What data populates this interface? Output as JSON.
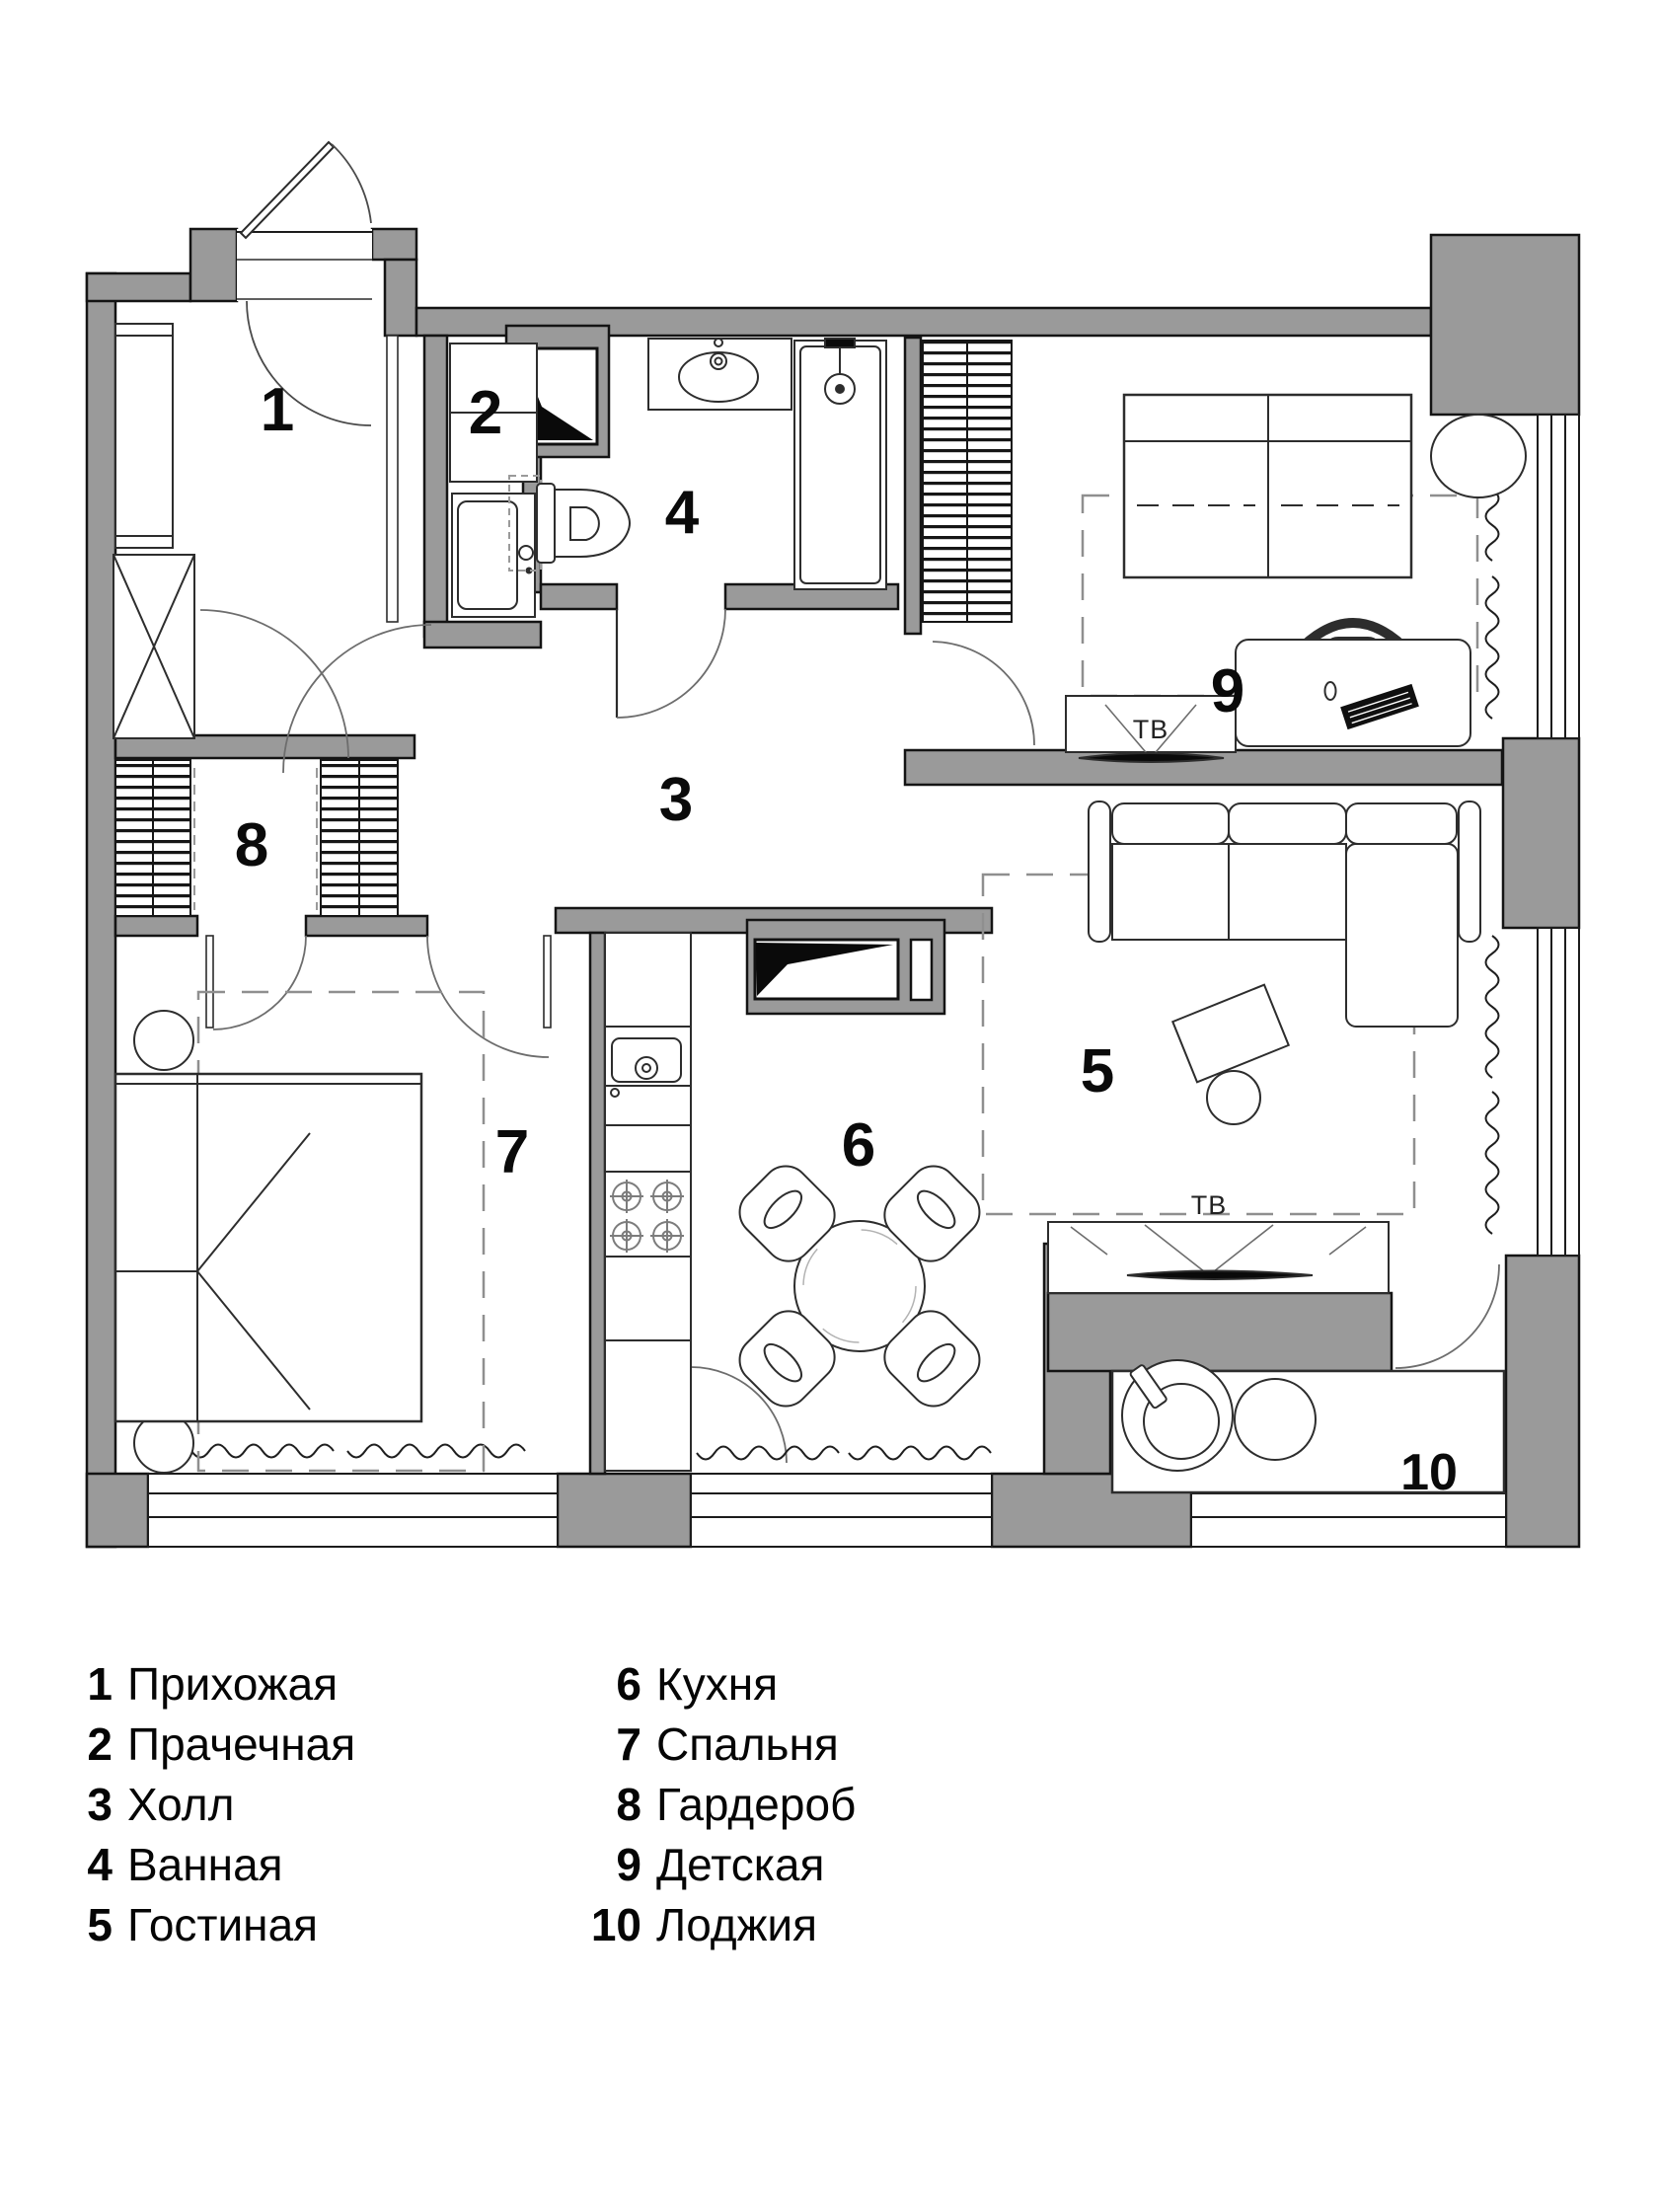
{
  "plan": {
    "rooms": [
      {
        "number": "1",
        "name": "Прихожая"
      },
      {
        "number": "2",
        "name": "Прачечная"
      },
      {
        "number": "3",
        "name": "Холл"
      },
      {
        "number": "4",
        "name": "Ванная"
      },
      {
        "number": "5",
        "name": "Гостиная"
      },
      {
        "number": "6",
        "name": "Кухня"
      },
      {
        "number": "7",
        "name": "Спальня"
      },
      {
        "number": "8",
        "name": "Гардероб"
      },
      {
        "number": "9",
        "name": "Детская"
      },
      {
        "number": "10",
        "name": "Лоджия"
      }
    ],
    "tv_label": "ТВ",
    "colors": {
      "wall": "#9a9a9a",
      "outline": "#141414",
      "dash": "#8f8f8f"
    }
  },
  "legend": {
    "items": [
      {
        "num": "1",
        "label": "Прихожая"
      },
      {
        "num": "2",
        "label": "Прачечная"
      },
      {
        "num": "3",
        "label": "Холл"
      },
      {
        "num": "4",
        "label": "Ванная"
      },
      {
        "num": "5",
        "label": "Гостиная"
      },
      {
        "num": "6",
        "label": "Кухня"
      },
      {
        "num": "7",
        "label": "Спальня"
      },
      {
        "num": "8",
        "label": "Гардероб"
      },
      {
        "num": "9",
        "label": "Детская"
      },
      {
        "num": "10",
        "label": "Лоджия"
      }
    ]
  }
}
